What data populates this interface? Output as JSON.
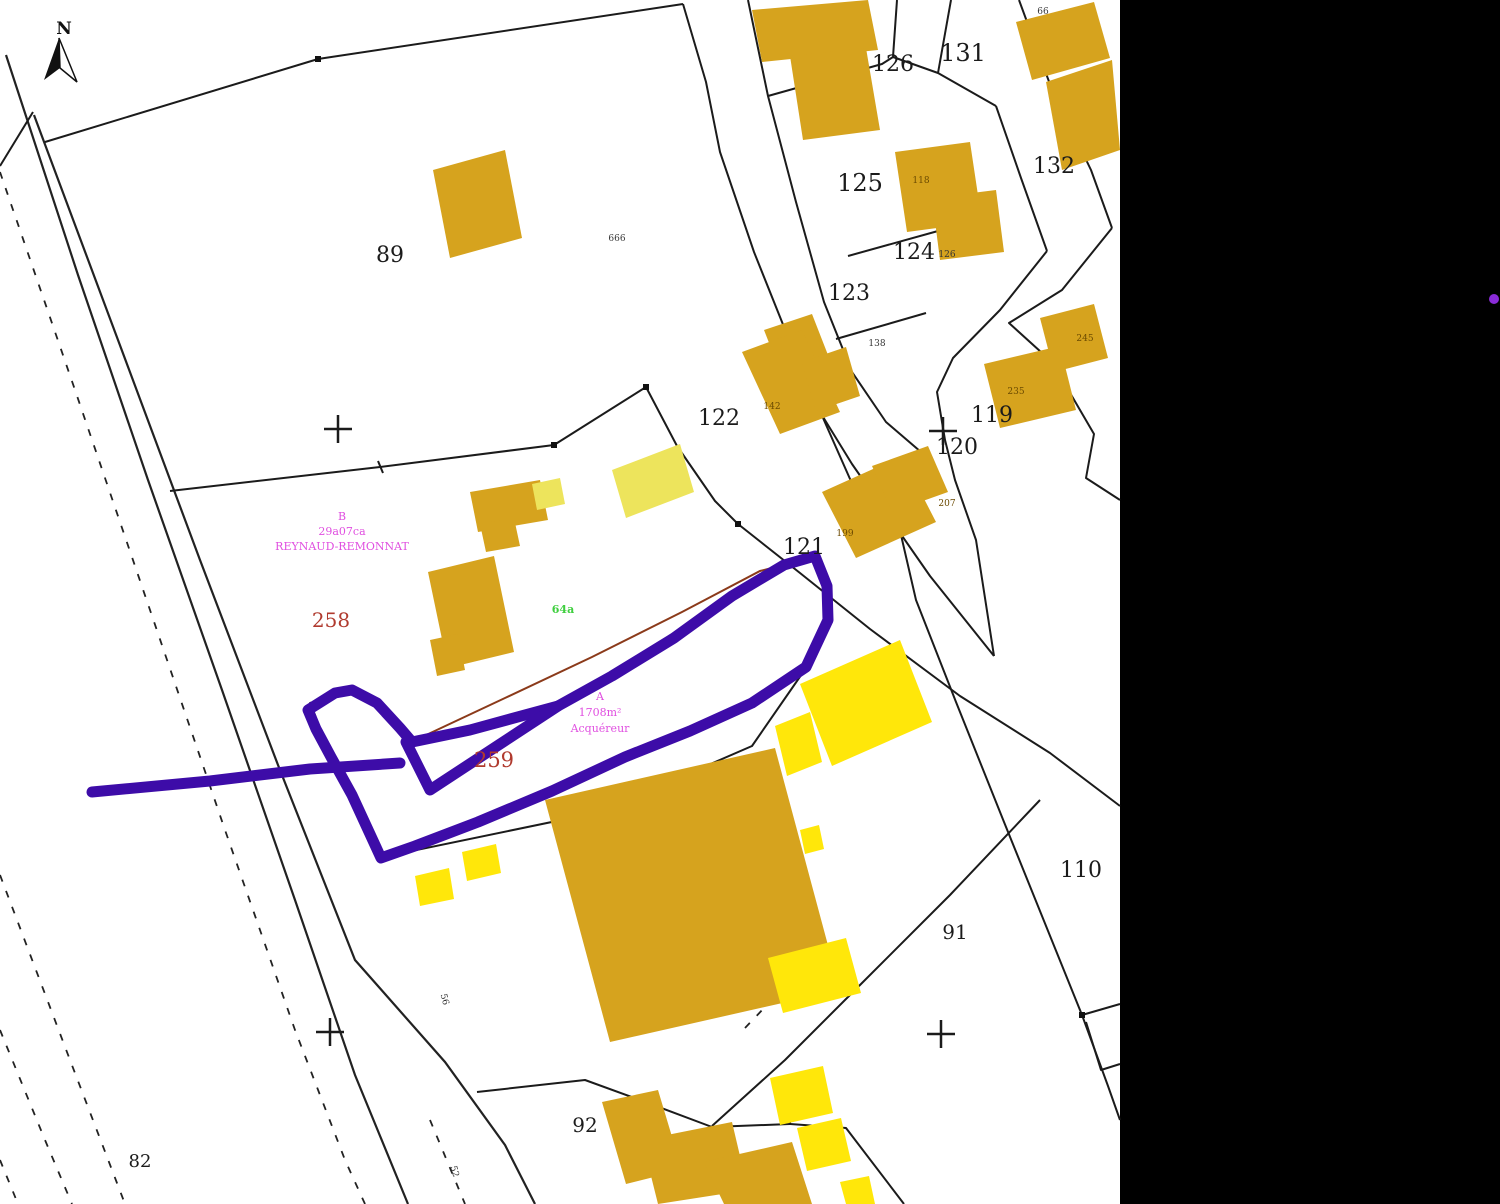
{
  "map": {
    "type": "cadastral-plan",
    "north_label": "N"
  },
  "colors": {
    "background": "#000000",
    "map_paper": "#ffffff",
    "building_ochre": "#D6A31E",
    "building_yellow": "#FFE70A",
    "building_pale_yellow": "#EDE45C",
    "annotation_purple": "#3D0CA8",
    "parcel_text": "#1b1b1b",
    "red_parcel_text": "#B03A2E",
    "pink_text": "#E04FE0",
    "green_text": "#3FCF3F",
    "thin_red_line": "#8B3A1A",
    "right_band_dot": "#8A2BD8"
  },
  "annotations": {
    "block_b": [
      "B",
      "29a07ca",
      "REYNAUD-REMONNAT"
    ],
    "block_a": [
      "A",
      "1708m²",
      "Acquéreur"
    ],
    "green_note": "64a",
    "red_parcels": [
      "258",
      "259"
    ]
  },
  "labels": [
    {
      "t": "89",
      "x": 390,
      "y": 262,
      "s": 22,
      "n": "parcel-label-89"
    },
    {
      "t": "126",
      "x": 893,
      "y": 71,
      "s": 22,
      "n": "parcel-label-126"
    },
    {
      "t": "131",
      "x": 963,
      "y": 61,
      "s": 24,
      "n": "parcel-label-131"
    },
    {
      "t": "125",
      "x": 860,
      "y": 191,
      "s": 24,
      "n": "parcel-label-125"
    },
    {
      "t": "124",
      "x": 914,
      "y": 259,
      "s": 22,
      "n": "parcel-label-124"
    },
    {
      "t": "123",
      "x": 849,
      "y": 300,
      "s": 22,
      "n": "parcel-label-123"
    },
    {
      "t": "132",
      "x": 1054,
      "y": 173,
      "s": 22,
      "n": "parcel-label-132"
    },
    {
      "t": "122",
      "x": 719,
      "y": 425,
      "s": 22,
      "n": "parcel-label-122"
    },
    {
      "t": "119",
      "x": 992,
      "y": 422,
      "s": 22,
      "n": "parcel-label-119"
    },
    {
      "t": "120",
      "x": 957,
      "y": 454,
      "s": 22,
      "n": "parcel-label-120"
    },
    {
      "t": "121",
      "x": 804,
      "y": 554,
      "s": 22,
      "n": "parcel-label-121"
    },
    {
      "t": "110",
      "x": 1081,
      "y": 877,
      "s": 22,
      "n": "parcel-label-110"
    },
    {
      "t": "91",
      "x": 955,
      "y": 939,
      "s": 20,
      "n": "parcel-label-91"
    },
    {
      "t": "92",
      "x": 585,
      "y": 1132,
      "s": 20,
      "n": "parcel-label-92"
    },
    {
      "t": "82",
      "x": 140,
      "y": 1167,
      "s": 18,
      "n": "parcel-label-82"
    },
    {
      "t": "258",
      "x": 331,
      "y": 627,
      "s": 20,
      "c": "#B03A2E",
      "n": "parcel-label-258"
    },
    {
      "t": "259",
      "x": 494,
      "y": 767,
      "s": 21,
      "c": "#B03A2E",
      "n": "parcel-label-259"
    },
    {
      "t": "666",
      "x": 617,
      "y": 241,
      "s": 9,
      "c": "#333333",
      "n": "building-number-666"
    },
    {
      "t": "66",
      "x": 1043,
      "y": 14,
      "s": 9,
      "c": "#333333",
      "n": "building-number-66"
    },
    {
      "t": "118",
      "x": 921,
      "y": 183,
      "s": 9,
      "c": "#6b4a00",
      "n": "building-number-118"
    },
    {
      "t": "126",
      "x": 947,
      "y": 257,
      "s": 9,
      "c": "#333333",
      "n": "building-number-126"
    },
    {
      "t": "138",
      "x": 877,
      "y": 346,
      "s": 9,
      "c": "#333333",
      "n": "building-number-138"
    },
    {
      "t": "142",
      "x": 772,
      "y": 409,
      "s": 9,
      "c": "#6b4a00",
      "n": "building-number-142"
    },
    {
      "t": "245",
      "x": 1085,
      "y": 341,
      "s": 9,
      "c": "#6b4a00",
      "n": "building-number-245"
    },
    {
      "t": "235",
      "x": 1016,
      "y": 394,
      "s": 9,
      "c": "#6b4a00",
      "n": "building-number-235"
    },
    {
      "t": "207",
      "x": 947,
      "y": 506,
      "s": 9,
      "c": "#6b4a00",
      "n": "building-number-207"
    },
    {
      "t": "199",
      "x": 845,
      "y": 536,
      "s": 9,
      "c": "#6b4a00",
      "n": "building-number-199"
    },
    {
      "t": "B",
      "x": 342,
      "y": 520,
      "s": 11,
      "c": "#E04FE0",
      "n": "annotation-b-letter"
    },
    {
      "t": "29a07ca",
      "x": 342,
      "y": 535,
      "s": 11,
      "c": "#E04FE0",
      "n": "annotation-b-area"
    },
    {
      "t": "REYNAUD-REMONNAT",
      "x": 342,
      "y": 550,
      "s": 11,
      "c": "#E04FE0",
      "n": "annotation-b-name"
    },
    {
      "t": "A",
      "x": 600,
      "y": 700,
      "s": 11,
      "c": "#E04FE0",
      "n": "annotation-a-letter"
    },
    {
      "t": "1708m²",
      "x": 600,
      "y": 716,
      "s": 11,
      "c": "#E04FE0",
      "n": "annotation-a-area"
    },
    {
      "t": "Acquéreur",
      "x": 600,
      "y": 732,
      "s": 11,
      "c": "#E04FE0",
      "n": "annotation-a-name"
    },
    {
      "t": "64a",
      "x": 563,
      "y": 613,
      "s": 11,
      "c": "#3FCF3F",
      "b": 1,
      "n": "green-note"
    },
    {
      "t": "56",
      "x": 442,
      "y": 1000,
      "s": 9,
      "c": "#333333",
      "r": 75,
      "n": "edge-note-56"
    },
    {
      "t": "52",
      "x": 452,
      "y": 1172,
      "s": 9,
      "c": "#333333",
      "r": 75,
      "n": "edge-note-52"
    }
  ]
}
